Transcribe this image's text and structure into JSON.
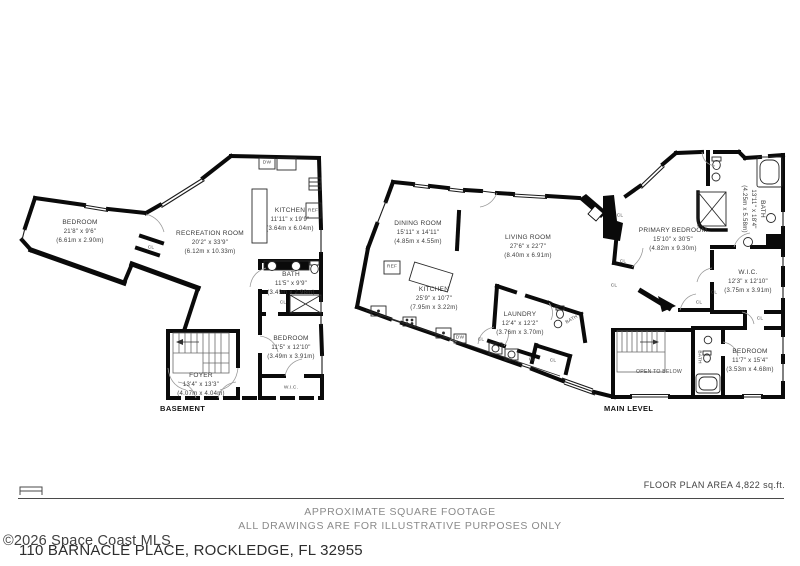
{
  "plans": [
    {
      "caption": "BASEMENT",
      "rooms": [
        {
          "name": "BEDROOM",
          "imperial": "21'8\" x 9'6\"",
          "metric": "(6.61m x 2.90m)"
        },
        {
          "name": "RECREATION ROOM",
          "imperial": "20'2\" x 33'9\"",
          "metric": "(6.12m x 10.33m)"
        },
        {
          "name": "KITCHEN",
          "imperial": "11'11\" x 19'9\"",
          "metric": "(3.64m x 6.04m)"
        },
        {
          "name": "BATH",
          "imperial": "11'5\" x 9'9\"",
          "metric": "(3.49m x 2.98m)"
        },
        {
          "name": "BEDROOM",
          "imperial": "11'5\" x 12'10\"",
          "metric": "(3.49m x 3.91m)"
        },
        {
          "name": "FOYER",
          "imperial": "13'4\" x 13'3\"",
          "metric": "(4.07m x 4.04m)"
        }
      ]
    },
    {
      "caption": "MAIN LEVEL",
      "rooms": [
        {
          "name": "DINING ROOM",
          "imperial": "15'11\" x 14'11\"",
          "metric": "(4.85m x 4.55m)"
        },
        {
          "name": "LIVING ROOM",
          "imperial": "27'6\" x 22'7\"",
          "metric": "(8.40m x 6.91m)"
        },
        {
          "name": "KITCHEN",
          "imperial": "25'9\" x 10'7\"",
          "metric": "(7.95m x 3.22m)"
        },
        {
          "name": "LAUNDRY",
          "imperial": "12'4\" x 12'2\"",
          "metric": "(3.76m x 3.70m)"
        },
        {
          "name": "PRIMARY BEDROOM",
          "imperial": "15'10\" x 30'5\"",
          "metric": "(4.82m x 9.30m)"
        },
        {
          "name": "BATH",
          "imperial": "13'11\" x 18'4\"",
          "metric": "(4.25m x 5.58m)"
        },
        {
          "name": "W.I.C.",
          "imperial": "12'3\" x 12'10\"",
          "metric": "(3.75m x 3.91m)"
        },
        {
          "name": "BEDROOM",
          "imperial": "11'7\" x 15'4\"",
          "metric": "(3.53m x 4.68m)"
        }
      ]
    }
  ],
  "tiny_labels": [
    {
      "text": "W.I.C."
    },
    {
      "text": "CL"
    },
    {
      "text": "CL"
    },
    {
      "text": "DW"
    },
    {
      "text": "REF"
    },
    {
      "text": "REF"
    },
    {
      "text": "DW"
    },
    {
      "text": "CL"
    },
    {
      "text": "CL"
    },
    {
      "text": "BATH"
    },
    {
      "text": "BATH"
    },
    {
      "text": "CL"
    },
    {
      "text": "CL"
    },
    {
      "text": "CL"
    },
    {
      "text": "CL"
    },
    {
      "text": "CL"
    },
    {
      "text": "CL"
    },
    {
      "text": "OPEN TO BELOW"
    },
    {
      "text": "CL"
    }
  ],
  "footer": {
    "floor_area": "FLOOR PLAN AREA 4,822 sq.ft.",
    "disclaimer1": "APPROXIMATE SQUARE FOOTAGE",
    "disclaimer2": "ALL DRAWINGS ARE FOR ILLUSTRATIVE PURPOSES ONLY",
    "copyright": "©2026 Space Coast MLS",
    "address": "110 BARNACLE PLACE, ROCKLEDGE, FL 32955"
  },
  "colors": {
    "wall": "#0a0a0a",
    "label": "#3a3a3a",
    "muted": "#8a8a8a"
  }
}
